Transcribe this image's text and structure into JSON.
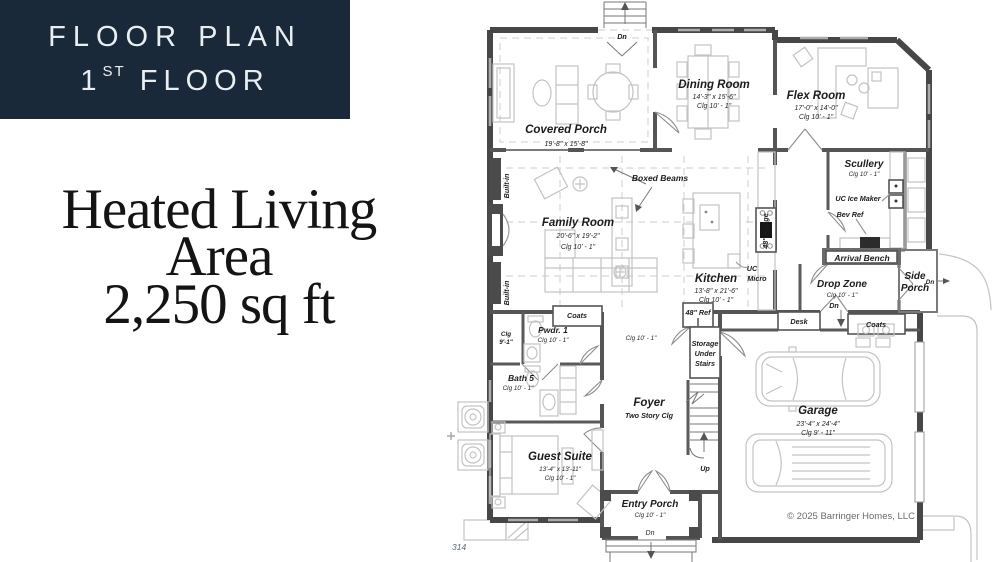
{
  "header": {
    "title": "FLOOR PLAN",
    "floor_number": "1",
    "floor_ordinal": "ST",
    "floor_word": "FLOOR"
  },
  "hero": {
    "line1": "Heated Living",
    "line2": "Area",
    "line3": "2,250 sq ft"
  },
  "plan": {
    "shared": {
      "clg_10_1": "Clg 10' - 1\"",
      "dn": "Dn",
      "up": "Up",
      "coats": "Coats",
      "built_in": "Built-in"
    },
    "rooms": {
      "covered_porch": {
        "name": "Covered Porch",
        "dims": "19'-8\" x 15'-8\""
      },
      "dining_room": {
        "name": "Dining Room",
        "dims": "14'-3\" x 15'-6\""
      },
      "flex_room": {
        "name": "Flex Room",
        "dims": "17'-0\" x 14'-0\""
      },
      "scullery": {
        "name": "Scullery"
      },
      "family_room": {
        "name": "Family Room",
        "dims": "20'-6\" x 19'-2\""
      },
      "kitchen": {
        "name": "Kitchen",
        "dims": "13'-8\" x 21'-6\""
      },
      "drop_zone": {
        "name": "Drop Zone"
      },
      "side_porch": {
        "name_line1": "Side",
        "name_line2": "Porch"
      },
      "pwdr": {
        "name": "Pwdr. 1"
      },
      "closet": {
        "clg_line1": "Clg",
        "clg_line2": "9'-1\""
      },
      "bath5": {
        "name": "Bath 5"
      },
      "foyer": {
        "name": "Foyer",
        "note": "Two Story Clg"
      },
      "guest_suite": {
        "name": "Guest Suite",
        "dims": "13'-4\" x 13'-11\""
      },
      "entry_porch": {
        "name": "Entry Porch"
      },
      "garage": {
        "name": "Garage",
        "dims": "23'-4\" x 24'-4\"",
        "clg": "Clg 9' - 11\""
      }
    },
    "labels": {
      "boxed_beams": "Boxed Beams",
      "uc_ice_maker": "UC Ice Maker",
      "bev_ref": "Bev Ref",
      "arrival_bench": "Arrival Bench",
      "range_48": "48\" Range",
      "ref_48": "48\" Ref",
      "desk": "Desk",
      "uc": "UC",
      "micro": "Micro",
      "storage_1": "Storage",
      "storage_2": "Under",
      "storage_3": "Stairs"
    },
    "footer": {
      "copyright": "© 2025 Barringer Homes, LLC",
      "page": "314"
    }
  },
  "colors": {
    "title_bg": "#1a2939",
    "title_text": "#e9eef3",
    "wall": "#474747",
    "furniture": "#c3c3c3"
  }
}
